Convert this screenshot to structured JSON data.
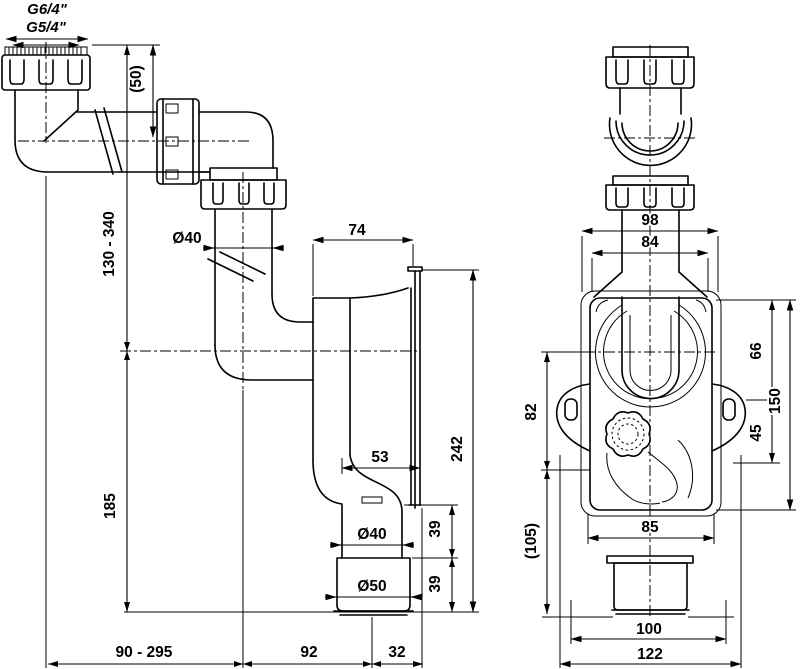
{
  "drawing": {
    "side_view": {
      "thread_top": "G6/4\"",
      "thread_bottom": "G5/4\"",
      "inlet_adjust": "(50)",
      "height_range": "130 - 340",
      "inlet_diameter": "Ø40",
      "body_to_wall": "74",
      "flange_height": "242",
      "outlet_to_wall_upper": "53",
      "outlet_diameter": "Ø40",
      "cup_diameter": "Ø50",
      "spacing_upper": "39",
      "spacing_lower": "39",
      "outlet_drop": "185",
      "horizontal_range": "90 - 295",
      "trap_to_outlet": "92",
      "outlet_to_wall": "32"
    },
    "front_view": {
      "nut_width": "98",
      "pipe_width": "84",
      "body_width": "85",
      "flange_width": "100",
      "total_width": "122",
      "top_to_hole": "66",
      "hole_to_plug": "45",
      "body_height": "150",
      "center_to_hole": "82",
      "hole_to_bottom": "(105)"
    },
    "colors": {
      "ink": "#000000",
      "paper": "#ffffff"
    }
  }
}
